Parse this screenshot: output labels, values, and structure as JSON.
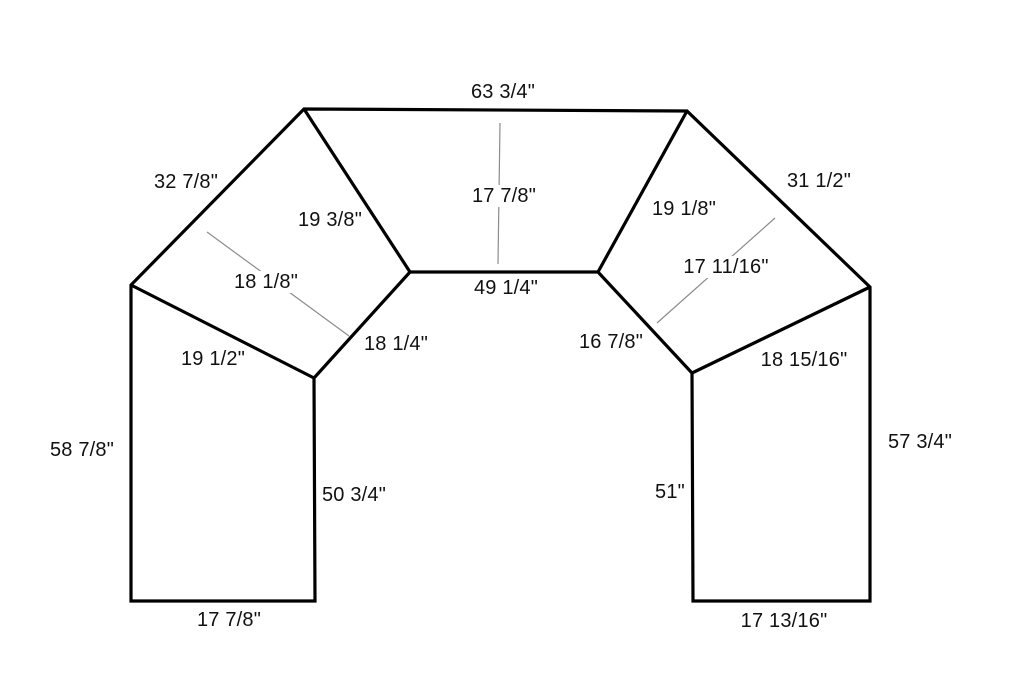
{
  "diagram": {
    "title": "countertop-measurement-drawing",
    "colors": {
      "background": "#ffffff",
      "outline": "#000000",
      "seam": "#000000",
      "dimension_line": "#8c8c8c",
      "text": "#111111"
    },
    "outline_points": [
      [
        304,
        109
      ],
      [
        687,
        111
      ],
      [
        870,
        287
      ],
      [
        870,
        601
      ],
      [
        693,
        601
      ],
      [
        692,
        373
      ],
      [
        598,
        272
      ],
      [
        410,
        272
      ],
      [
        314,
        378
      ],
      [
        315,
        601
      ],
      [
        131,
        601
      ],
      [
        131,
        285
      ]
    ],
    "seam_lines": [
      {
        "name": "seam-upper-left",
        "from": [
          304,
          109
        ],
        "to": [
          410,
          272
        ]
      },
      {
        "name": "seam-upper-right",
        "from": [
          687,
          111
        ],
        "to": [
          598,
          272
        ]
      },
      {
        "name": "seam-lower-left",
        "from": [
          131,
          285
        ],
        "to": [
          314,
          378
        ]
      },
      {
        "name": "seam-lower-right",
        "from": [
          870,
          287
        ],
        "to": [
          692,
          373
        ]
      }
    ],
    "dimension_lines": [
      {
        "name": "center-depth-line",
        "from": [
          500,
          123
        ],
        "to": [
          498,
          264
        ]
      },
      {
        "name": "left-corner-depth-line",
        "from": [
          207,
          232
        ],
        "to": [
          349,
          336
        ]
      },
      {
        "name": "right-corner-depth-line",
        "from": [
          775,
          218
        ],
        "to": [
          657,
          323
        ]
      }
    ],
    "labels": [
      {
        "text": "63 3/4\"",
        "x": 503,
        "y": 92,
        "bg": false
      },
      {
        "text": "32 7/8\"",
        "x": 186,
        "y": 182,
        "bg": false
      },
      {
        "text": "31 1/2\"",
        "x": 819,
        "y": 181,
        "bg": false
      },
      {
        "text": "19 3/8\"",
        "x": 330,
        "y": 220,
        "bg": false
      },
      {
        "text": "17 7/8\"",
        "x": 504,
        "y": 196,
        "bg": true
      },
      {
        "text": "19 1/8\"",
        "x": 684,
        "y": 209,
        "bg": false
      },
      {
        "text": "18 1/8\"",
        "x": 266,
        "y": 282,
        "bg": true
      },
      {
        "text": "17 11/16\"",
        "x": 726,
        "y": 267,
        "bg": true
      },
      {
        "text": "49 1/4\"",
        "x": 506,
        "y": 288,
        "bg": false
      },
      {
        "text": "18 1/4\"",
        "x": 396,
        "y": 344,
        "bg": false
      },
      {
        "text": "16 7/8\"",
        "x": 611,
        "y": 342,
        "bg": false
      },
      {
        "text": "19 1/2\"",
        "x": 213,
        "y": 359,
        "bg": false
      },
      {
        "text": "18 15/16\"",
        "x": 804,
        "y": 360,
        "bg": false
      },
      {
        "text": "58 7/8\"",
        "x": 82,
        "y": 450,
        "bg": false
      },
      {
        "text": "50 3/4\"",
        "x": 354,
        "y": 495,
        "bg": false
      },
      {
        "text": "51\"",
        "x": 670,
        "y": 492,
        "bg": false
      },
      {
        "text": "57 3/4\"",
        "x": 920,
        "y": 442,
        "bg": false
      },
      {
        "text": "17 7/8\"",
        "x": 229,
        "y": 620,
        "bg": false
      },
      {
        "text": "17 13/16\"",
        "x": 784,
        "y": 621,
        "bg": false
      }
    ],
    "stroke_widths": {
      "outline": 3.2,
      "seam": 3.2,
      "dimension": 1.2
    }
  }
}
